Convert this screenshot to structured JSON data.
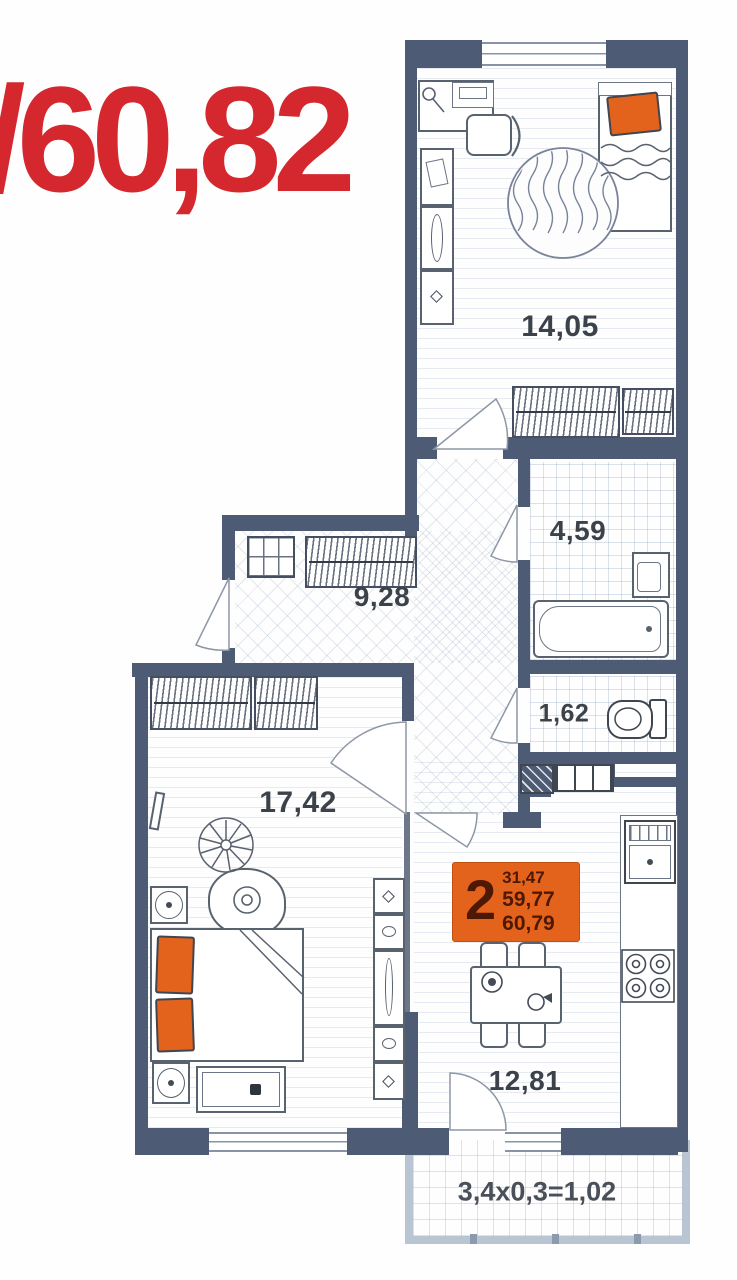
{
  "overlay": {
    "total_area_text": "/60,82",
    "color": "#d4282e"
  },
  "rooms": {
    "bedroom1": {
      "name": "bedroom-top",
      "label": "14,05"
    },
    "bathroom": {
      "name": "bathroom",
      "label": "4,59"
    },
    "hallway": {
      "name": "hallway",
      "label": "9,28"
    },
    "wc": {
      "name": "wc",
      "label": "1,62"
    },
    "bedroom2": {
      "name": "bedroom-master",
      "label": "17,42"
    },
    "kitchen": {
      "name": "kitchen-living",
      "label": "12,81"
    }
  },
  "badge": {
    "rooms_count": "2",
    "area_living": "31,47",
    "area_no_balcony": "59,77",
    "area_total": "60,79",
    "color": "#e4631c"
  },
  "balcony": {
    "label": "3,4x0,3=1,02"
  },
  "colors": {
    "wall": "#4e5b74",
    "balcony_wall": "#b9c5d3",
    "accent_orange": "#e4631c",
    "red": "#d4282e"
  },
  "furniture": [
    "desk",
    "desk-chair",
    "wardrobe-column",
    "round-rug",
    "single-bed",
    "wardrobe",
    "bathtub",
    "washbasin",
    "toilet",
    "shoe-shelf",
    "double-bed",
    "armchair",
    "plant",
    "side-table",
    "tv",
    "bench",
    "shelf-strip",
    "fridge",
    "stove",
    "counter",
    "dining-table",
    "dining-chair"
  ]
}
